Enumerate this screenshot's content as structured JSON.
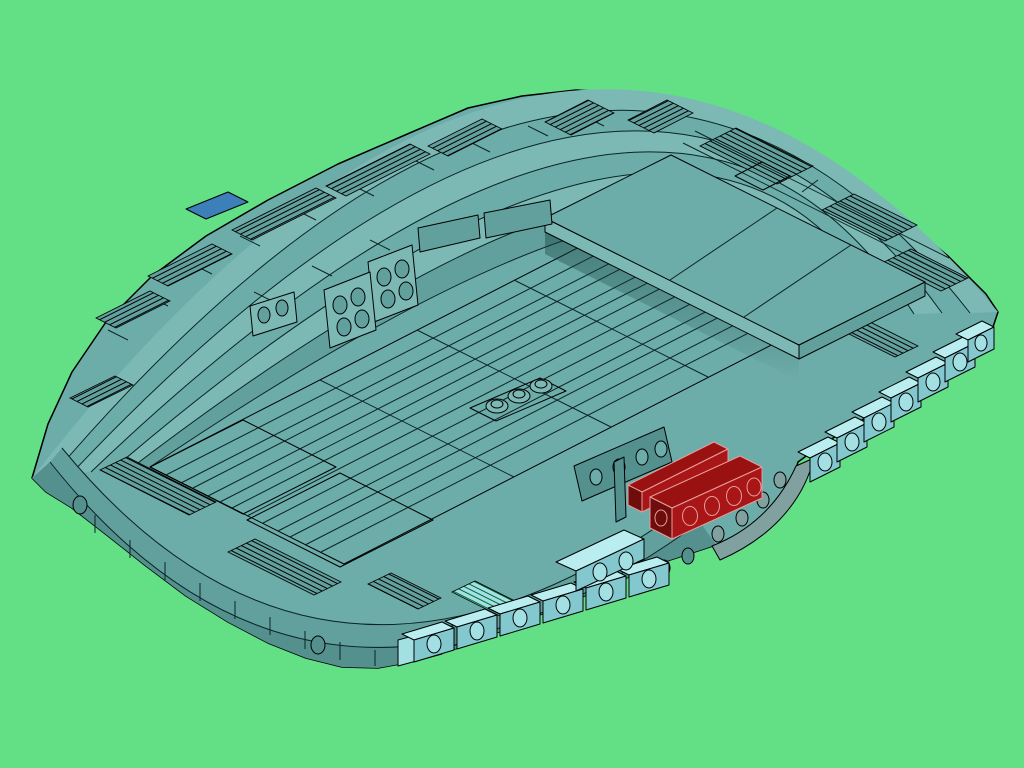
{
  "meta": {
    "title": "Isometric 3D render of a teal saucer-shaped brick model",
    "description": "CAD-style isometric render of a saucer-shaped LEGO-like hull built from teal plates with terraced stepped edges and grille-slope tiles, light-aqua side-stud bricks along the lower-right rim, two dark red 1x4 bricks near the lower right, standing stud plates on the deck, three round studs at the center, and one small blue tile on the upper-left rim, all on a flat green background.",
    "projection": "isometric",
    "background_style": "flat solid green"
  },
  "colors": {
    "background": "#63DF86",
    "body": "#6CACA9",
    "body_light": "#7CB9B5",
    "body_mid": "#62A09D",
    "body_dark": "#54908D",
    "body_darker": "#41716F",
    "cyan_top": "#B9EDF0",
    "cyan_left": "#A3E0E4",
    "cyan_side": "#84C8CF",
    "gray_side": "#80A19F",
    "red_top": "#9A1111",
    "red_side": "#A81617",
    "red_dark": "#6F0C0C",
    "red_edge": "#E89C9C",
    "blue_tile": "#3D7FB8",
    "edge": "#000000",
    "seam": "#0B2424"
  },
  "model": {
    "highlight_part": {
      "name": "dark-red-brick-1x4",
      "count": 2,
      "location": "lower-right deck edge"
    },
    "accent_parts": [
      {
        "name": "blue-tile",
        "count": 1,
        "location": "upper-left rim"
      },
      {
        "name": "light-aqua-side-stud-brick-row-right",
        "stud_count": 7
      },
      {
        "name": "light-aqua-side-stud-brick-row-bottom",
        "stud_count": 7
      },
      {
        "name": "light-aqua-wedge",
        "stud_count": 2
      },
      {
        "name": "grille-slope-patches",
        "count": 15
      },
      {
        "name": "standing-stud-plate-2x2",
        "count": 2,
        "stud_count": 8
      },
      {
        "name": "standing-stud-plate-1x2",
        "count": 1,
        "stud_count": 2
      },
      {
        "name": "center-round-studs",
        "count": 3
      },
      {
        "name": "side-stud-wall-behind-red-bricks",
        "stud_count": 4
      },
      {
        "name": "underside-curve-studs",
        "stud_count": 4
      }
    ]
  }
}
